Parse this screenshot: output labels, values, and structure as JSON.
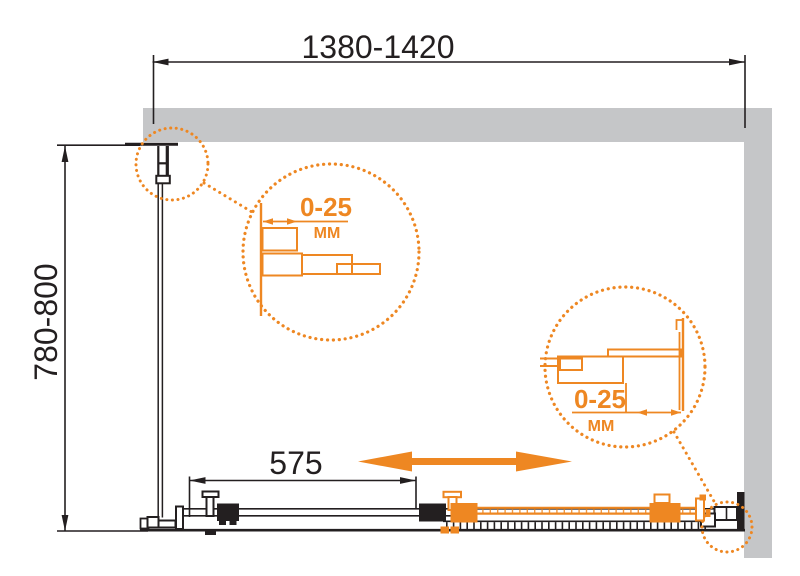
{
  "drawing": {
    "dimensions": {
      "width_range": "1380-1420",
      "depth_range": "780-800",
      "door_panel": "575"
    },
    "details": [
      {
        "adjustment": "0-25",
        "unit": "ММ"
      },
      {
        "adjustment": "0-25",
        "unit": "ММ"
      }
    ],
    "icons": {
      "slide_direction_arrow": "left-right-double-arrow",
      "detail_callout": "dotted-magnifier-circle"
    },
    "colors": {
      "accent": "#EE8722",
      "wall_gray": "#C5C6C8",
      "line_black": "#231F20",
      "background": "#FFFFFF"
    }
  }
}
